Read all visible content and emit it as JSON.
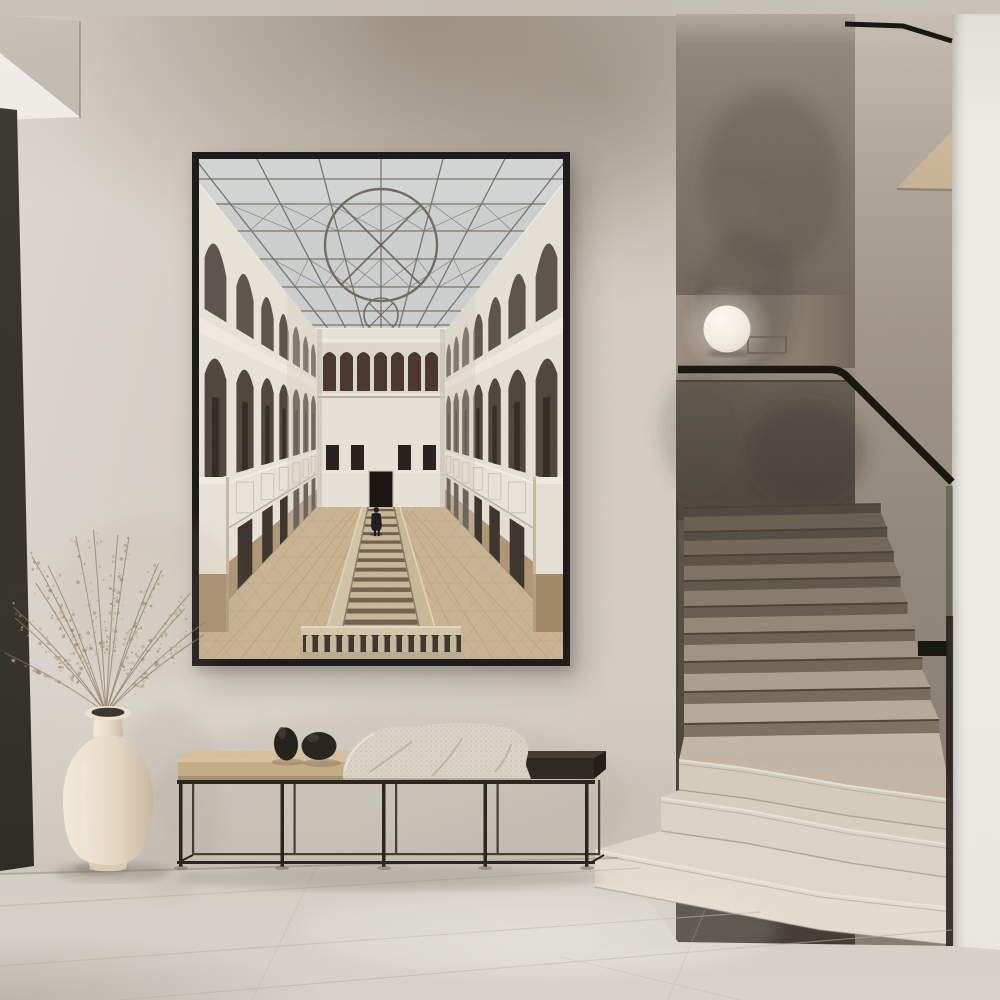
{
  "canvas": {
    "width": 1000,
    "height": 1000
  },
  "scene": {
    "description": "Minimalist hallway interior: large black-framed photographic poster of a historic atrium (glass skylight with circular tracery, arched galleries, sunken central staircase with lone figure), beside a terrazzo staircase with black handrail and glowing sphere lamp; below the poster a metal-frame bench with tan cushion, dark wood top, two black stones and a knit throw; at left a cream vase with dried grass on a tiled stone floor.",
    "visible_objects": [
      "framed-poster",
      "atrium-artwork",
      "sphere-lamp",
      "lamp-console",
      "handrail",
      "staircase-terrazzo",
      "landing-ledge",
      "bench",
      "bench-cushion",
      "bench-dark-top",
      "knit-throw",
      "decor-stones",
      "vase",
      "dried-grass",
      "tile-floor",
      "dark-door-panel",
      "ceiling-soffit",
      "right-wall-pillar"
    ]
  },
  "palette": {
    "ceiling": "#cac5bb",
    "wall": "#d3cdc3",
    "wall_stain": "#7d6d5c",
    "soffit_white": "#edece6",
    "soffit_fascia": "#c7c3b9",
    "door_dark": "#34322b",
    "stair_wall": "#5b534a",
    "landing_wall": "#8a7d6f",
    "ledge": "#8e867a",
    "parapet": "#554e45",
    "wedge_beige": "#d6c5a6",
    "pillar_white": "#efede7",
    "rail_black": "#16140f",
    "lamp": "#f5f2ea",
    "step_tan_dark": "#5e5448",
    "step_tan": "#9a8d7d",
    "step_white": "#e2dbce",
    "floor": "#d5d1c8",
    "grout": "#b5afa4",
    "bench_metal": "#27231d",
    "cushion": "#c5ac86",
    "bench_top_dark": "#2b2620",
    "stone": "#232019",
    "blanket": "#dad3c7",
    "vase": "#ece2d0",
    "vase_shade": "#d2c2ac",
    "grass": "#a8947d",
    "frame": "#1b1918",
    "art_glass": "#ccd0cf",
    "art_mullion": "#6e695c",
    "art_wall": "#e9e4da",
    "art_wall_r": "#e6e1d6",
    "art_arch": "#4c443b",
    "art_arch_inner": "#2e2922",
    "art_end": "#e8e3d8",
    "art_loggia": "#47332b",
    "art_win": "#241d17",
    "art_door": "#141009",
    "art_floor": "#c9b492",
    "art_tile": "#ac9574",
    "art_curb": "#d2c4a5",
    "art_riser": "#5f4f3d",
    "art_channel": "#c7b798",
    "art_baluster": "#c6b89b",
    "art_bal_dark": "#3a3127",
    "art_pillar_tan": "#ab9170",
    "art_figure": "#1b181d",
    "art_cornice": "#f1ede3"
  }
}
